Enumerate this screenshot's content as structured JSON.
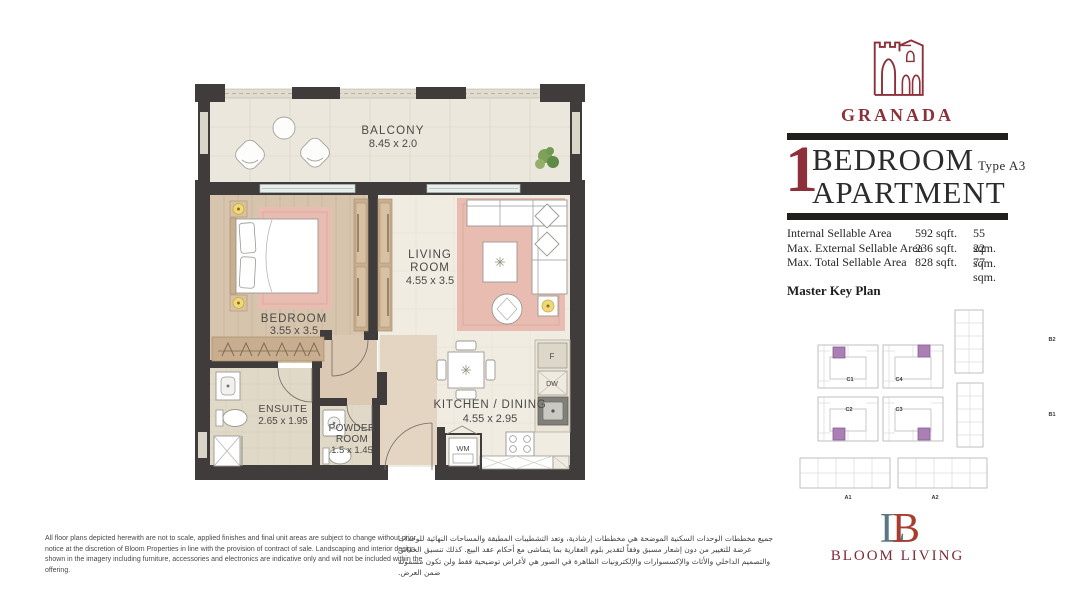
{
  "project": {
    "name": "GRANADA",
    "bedrooms": "1",
    "title_line1": "BEDROOM",
    "title_line2": "APARTMENT",
    "type": "Type A3"
  },
  "areas": {
    "rows": [
      {
        "label": "Internal Sellable Area",
        "sqft": "592 sqft.",
        "sqm": "55 sqm."
      },
      {
        "label": "Max. External Sellable Area",
        "sqft": "236 sqft.",
        "sqm": "22 sqm."
      },
      {
        "label": "Max. Total Sellable Area",
        "sqft": "828 sqft.",
        "sqm": "77 sqm."
      }
    ]
  },
  "key_plan": {
    "heading": "Master Key Plan",
    "labels": {
      "c1": "C1",
      "c2": "C2",
      "c3": "C3",
      "c4": "C4",
      "b1": "B1",
      "b2": "B2",
      "a1": "A1",
      "a2": "A2"
    }
  },
  "floor_plan": {
    "balcony_name": "BALCONY",
    "balcony_dims": "8.45 x 2.0",
    "living_name1": "LIVING",
    "living_name2": "ROOM",
    "living_dims": "4.55 x 3.5",
    "bedroom_name": "BEDROOM",
    "bedroom_dims": "3.55 x 3.5",
    "ensuite_name": "ENSUITE",
    "ensuite_dims": "2.65 x 1.95",
    "powder_name1": "POWDER",
    "powder_name2": "ROOM",
    "powder_dims": "1.5 x 1.45",
    "kitchen_name": "KITCHEN / DINING",
    "kitchen_dims": "4.55 x 2.95",
    "fridge": "F",
    "dishwasher": "DW",
    "washer": "WM"
  },
  "brand": {
    "name": "BLOOM LIVING"
  },
  "disclaimer": {
    "en": "All floor plans depicted herewith are not to scale, applied finishes and final unit areas are subject to change without prior notice at the discretion of Bloom Properties in line with the provision of contract of sale. Landscaping and interior design shown in the imagery including furniture, accessories and electronics are indicative only and will not be included within the offering.",
    "ar": "جميع مخططات الوحدات السكنية الموضحة هي مخططات إرشادية، وتعد التشطيبات المطبقة والمساحات النهائية للوحدات عرضة للتغيير من دون إشعار مسبق وفقاً لتقدير بلوم العقارية بما يتماشى مع أحكام عقد البيع. كذلك تنسيق الحدائق والتصميم الداخلي والأثاث والإكسسوارات والإلكترونيات الظاهرة في الصور هي لأغراض توضيحية فقط ولن تكون مشمولة ضمن العرض."
  },
  "colors": {
    "brand_maroon": "#8e3039",
    "bar_black": "#211e1e",
    "wall_dark": "#403c3b",
    "highlight_purple": "#a97fb4",
    "rug_pink": "#e9bcb1",
    "wood": "#d7c4ad"
  }
}
